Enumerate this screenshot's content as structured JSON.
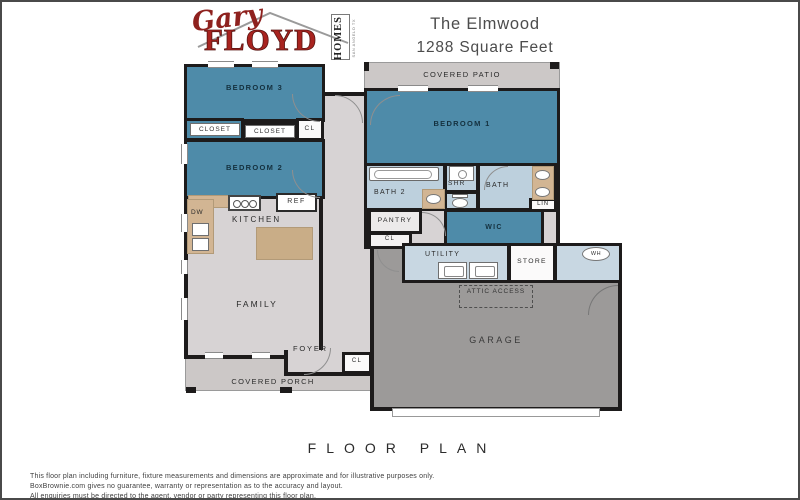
{
  "header": {
    "logo_script": "Gary",
    "logo_name": "FLOYD",
    "logo_homes": "HOMES",
    "logo_tagline": "SAN ANGELO TX",
    "title_line1": "The Elmwood",
    "title_line2": "1288 Square Feet"
  },
  "rooms": {
    "covered_patio": "COVERED PATIO",
    "bedroom3": "BEDROOM 3",
    "closet_a": "CLOSET",
    "closet_b": "CLOSET",
    "cl_hall": "CL",
    "bedroom2": "BEDROOM 2",
    "bedroom1": "BEDROOM 1",
    "bath2": "BATH 2",
    "shr": "SHR",
    "bath": "BATH",
    "lin": "LIN",
    "ref": "REF",
    "dw": "DW",
    "kitchen": "KITCHEN",
    "pantry": "PANTRY",
    "cl_pantry": "CL",
    "wic": "WIC",
    "utility": "UTILITY",
    "store": "STORE",
    "wh": "WH",
    "attic_access": "ATTIC ACCESS",
    "garage": "GARAGE",
    "family": "FAMILY",
    "foyer": "FOYER",
    "cl_foyer": "CL",
    "covered_porch": "COVERED PORCH"
  },
  "footer": {
    "heading": "FLOOR PLAN",
    "disclaimer_line1": "This floor plan including furniture, fixture measurements and dimensions are approximate and for illustrative purposes only.",
    "disclaimer_line2": "BoxBrownie.com gives no guarantee, warranty or representation as to the accuracy and layout.",
    "disclaimer_line3": "All enquiries must be directed to the agent, vendor or party representing this floor plan."
  },
  "colors": {
    "bedroom_blue": "#4e8ba9",
    "bath_blue": "#bdd0dd",
    "utility_blue": "#c8d7e2",
    "floor_gray": "#d7d3d4",
    "patio_gray": "#ccc8c7",
    "garage_gray": "#9c9a99",
    "wall_black": "#1d1b1b",
    "counter_tan": "#d2b593",
    "logo_red": "#a8231f"
  }
}
